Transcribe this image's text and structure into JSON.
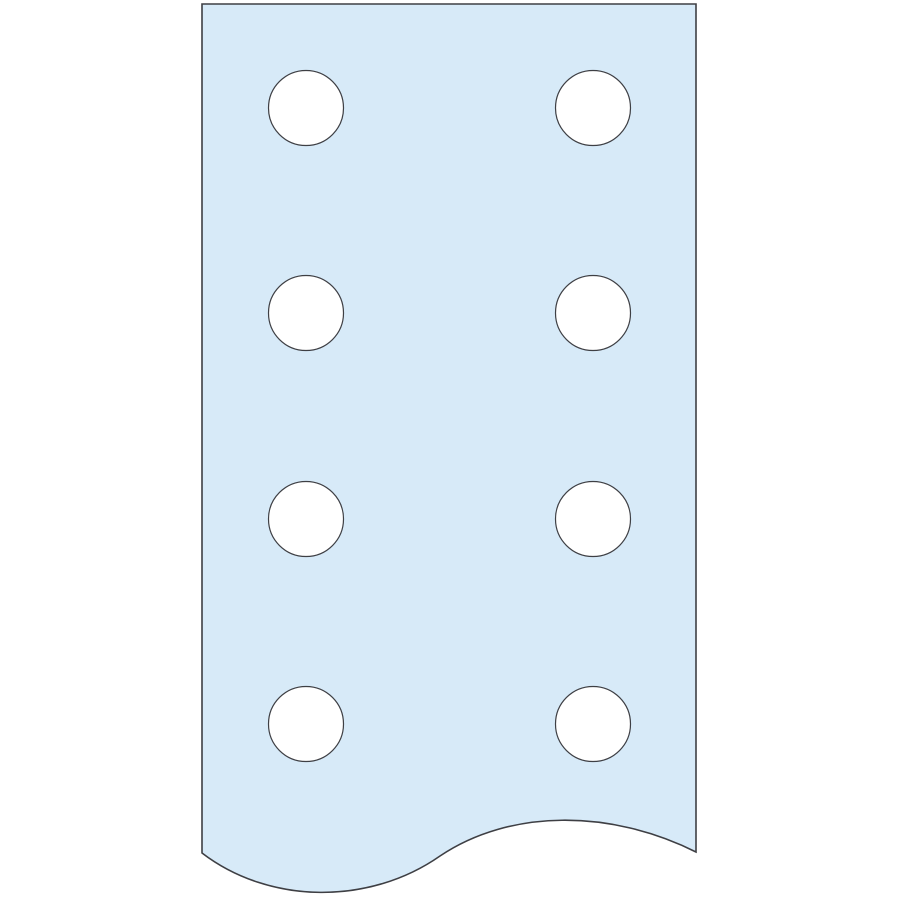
{
  "canvas": {
    "width": 900,
    "height": 900,
    "background_color": "#ffffff"
  },
  "illustration": {
    "subject": "perforated-flat-bar",
    "fill_color": "#d7eaf8",
    "stroke_color": "#3e3f44",
    "outline_stroke_width": 1.6,
    "hole_stroke_width": 1.2,
    "outline_path": "M 202 4 L 696 4 L 696 852 C 610 809 510 809 440 856 C 370 905 270 905 202 853 Z",
    "holes": {
      "fill_color": "#ffffff",
      "radius": 37.5,
      "centers": [
        {
          "x": 306,
          "y": 108
        },
        {
          "x": 593,
          "y": 108
        },
        {
          "x": 306,
          "y": 313
        },
        {
          "x": 593,
          "y": 313
        },
        {
          "x": 306,
          "y": 519
        },
        {
          "x": 593,
          "y": 519
        },
        {
          "x": 306,
          "y": 724
        },
        {
          "x": 593,
          "y": 724
        }
      ]
    }
  }
}
